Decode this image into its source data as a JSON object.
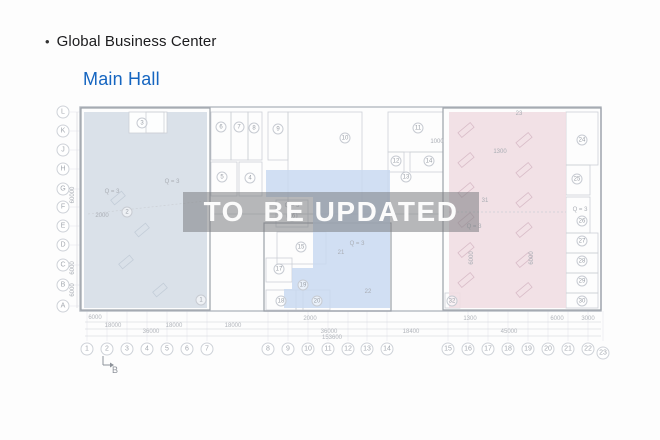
{
  "header": {
    "bullet": "•",
    "title": "Global Business Center",
    "subtitle": "Main Hall"
  },
  "watermark": {
    "text": "TO  BE UPDATED"
  },
  "colors": {
    "title": "#1c1c1e",
    "subtitle": "#1565c0",
    "left_fill": "#d4dce5",
    "mid_fill": "#c9d9f1",
    "right_fill": "#f0dde3",
    "outer_stroke": "#b5bac1",
    "section_stroke": "#9ba1a9",
    "room_stroke": "#ccd0d6",
    "hatch_pink": "#d9bcc8",
    "hatch_gray": "#c3cdd8",
    "dim_line": "#dcdee2",
    "tick_line": "#e9eaee",
    "band": "rgba(124,126,130,0.55)",
    "band_text": "#fbfbfb"
  },
  "plan": {
    "outer": [
      80,
      107,
      521,
      204
    ],
    "sections": [
      [
        81,
        108,
        129,
        202
      ],
      [
        264,
        223,
        127,
        88
      ],
      [
        443,
        108,
        158,
        202
      ]
    ],
    "walls": [
      [
        210,
        214,
        443,
        214
      ],
      [
        388,
        172,
        388,
        214
      ],
      [
        443,
        112,
        443,
        214
      ]
    ],
    "rooms": [
      [
        211,
        112,
        20,
        48
      ],
      [
        231,
        112,
        17,
        48
      ],
      [
        248,
        112,
        14,
        48
      ],
      [
        268,
        112,
        20,
        48
      ],
      [
        288,
        112,
        74,
        102
      ],
      [
        388,
        112,
        55,
        40
      ],
      [
        388,
        152,
        16,
        20
      ],
      [
        410,
        152,
        33,
        20
      ],
      [
        211,
        162,
        26,
        34
      ],
      [
        239,
        162,
        23,
        34
      ],
      [
        276,
        200,
        32,
        27
      ],
      [
        277,
        232,
        49,
        32
      ],
      [
        266,
        258,
        26,
        24
      ],
      [
        266,
        290,
        30,
        20
      ],
      [
        296,
        290,
        7,
        20
      ],
      [
        303,
        290,
        27,
        20
      ],
      [
        566,
        112,
        32,
        53
      ],
      [
        566,
        165,
        24,
        30
      ],
      [
        566,
        197,
        24,
        36
      ],
      [
        566,
        233,
        32,
        20
      ],
      [
        566,
        253,
        32,
        20
      ],
      [
        566,
        273,
        32,
        20
      ],
      [
        566,
        293,
        32,
        15
      ],
      [
        445,
        293,
        15,
        15
      ]
    ],
    "left_region": {
      "rect": [
        84,
        112,
        123,
        196
      ],
      "notch": [
        129,
        112,
        38,
        21
      ],
      "notch_room": [
        146,
        112,
        18,
        21
      ]
    },
    "right_region": {
      "rect": [
        449,
        112,
        117,
        196
      ]
    },
    "blue_polygon": [
      [
        266,
        170
      ],
      [
        390,
        170
      ],
      [
        390,
        308
      ],
      [
        284,
        308
      ],
      [
        284,
        289
      ],
      [
        292,
        289
      ],
      [
        292,
        268
      ],
      [
        313,
        268
      ],
      [
        313,
        197
      ],
      [
        266,
        197
      ]
    ],
    "dashed_lines": [
      [
        449,
        212,
        566,
        212
      ],
      [
        88,
        214,
        205,
        201
      ]
    ],
    "circled_labels": [
      {
        "t": "3",
        "x": 142,
        "y": 123
      },
      {
        "t": "2",
        "x": 127,
        "y": 212
      },
      {
        "t": "1",
        "x": 201,
        "y": 300
      },
      {
        "t": "6",
        "x": 221,
        "y": 127
      },
      {
        "t": "7",
        "x": 239,
        "y": 127
      },
      {
        "t": "8",
        "x": 254,
        "y": 128
      },
      {
        "t": "9",
        "x": 278,
        "y": 129
      },
      {
        "t": "10",
        "x": 345,
        "y": 138
      },
      {
        "t": "11",
        "x": 418,
        "y": 128
      },
      {
        "t": "12",
        "x": 396,
        "y": 161
      },
      {
        "t": "14",
        "x": 429,
        "y": 161
      },
      {
        "t": "13",
        "x": 406,
        "y": 177
      },
      {
        "t": "5",
        "x": 222,
        "y": 177
      },
      {
        "t": "4",
        "x": 250,
        "y": 178
      },
      {
        "t": "15",
        "x": 301,
        "y": 247
      },
      {
        "t": "17",
        "x": 279,
        "y": 269
      },
      {
        "t": "19",
        "x": 303,
        "y": 285
      },
      {
        "t": "18",
        "x": 281,
        "y": 301
      },
      {
        "t": "20",
        "x": 317,
        "y": 301
      },
      {
        "t": "16",
        "x": 292,
        "y": 216
      },
      {
        "t": "24",
        "x": 582,
        "y": 140
      },
      {
        "t": "25",
        "x": 577,
        "y": 179
      },
      {
        "t": "26",
        "x": 582,
        "y": 221
      },
      {
        "t": "27",
        "x": 582,
        "y": 241
      },
      {
        "t": "28",
        "x": 582,
        "y": 261
      },
      {
        "t": "29",
        "x": 582,
        "y": 281
      },
      {
        "t": "30",
        "x": 582,
        "y": 301
      },
      {
        "t": "32",
        "x": 452,
        "y": 301
      }
    ],
    "plain_labels": [
      {
        "t": "Q = 3",
        "x": 112,
        "y": 192
      },
      {
        "t": "Q = 3",
        "x": 172,
        "y": 182
      },
      {
        "t": "2000",
        "x": 102,
        "y": 216
      },
      {
        "t": "Q = 3",
        "x": 292,
        "y": 206
      },
      {
        "t": "Q = 3",
        "x": 357,
        "y": 244
      },
      {
        "t": "21",
        "x": 341,
        "y": 253
      },
      {
        "t": "22",
        "x": 368,
        "y": 292
      },
      {
        "t": "31",
        "x": 485,
        "y": 201
      },
      {
        "t": "Q = 3",
        "x": 474,
        "y": 227
      },
      {
        "t": "Q = 3",
        "x": 580,
        "y": 210
      },
      {
        "t": "1300",
        "x": 500,
        "y": 152
      },
      {
        "t": "1000",
        "x": 437,
        "y": 142
      },
      {
        "t": "23",
        "x": 519,
        "y": 114
      },
      {
        "t": "6000",
        "x": 472,
        "y": 258,
        "rot": true
      },
      {
        "t": "6000",
        "x": 532,
        "y": 258,
        "rot": true
      },
      {
        "t": "60000",
        "x": 73,
        "y": 195,
        "rot": true
      },
      {
        "t": "6000",
        "x": 73,
        "y": 268,
        "rot": true
      },
      {
        "t": "6000",
        "x": 73,
        "y": 290,
        "rot": true
      }
    ],
    "grid_letters": {
      "x": 63,
      "items": [
        {
          "t": "L",
          "y": 112
        },
        {
          "t": "K",
          "y": 131
        },
        {
          "t": "J",
          "y": 150
        },
        {
          "t": "H",
          "y": 169
        },
        {
          "t": "G",
          "y": 189
        },
        {
          "t": "F",
          "y": 207
        },
        {
          "t": "E",
          "y": 226
        },
        {
          "t": "D",
          "y": 245
        },
        {
          "t": "C",
          "y": 265
        },
        {
          "t": "B",
          "y": 285
        },
        {
          "t": "A",
          "y": 306
        }
      ]
    },
    "grid_numbers": {
      "y": 349,
      "items": [
        {
          "t": "1",
          "x": 87
        },
        {
          "t": "2",
          "x": 107
        },
        {
          "t": "3",
          "x": 127
        },
        {
          "t": "4",
          "x": 147
        },
        {
          "t": "5",
          "x": 167
        },
        {
          "t": "6",
          "x": 187
        },
        {
          "t": "7",
          "x": 207
        },
        {
          "t": "8",
          "x": 268
        },
        {
          "t": "9",
          "x": 288
        },
        {
          "t": "10",
          "x": 308
        },
        {
          "t": "11",
          "x": 328
        },
        {
          "t": "12",
          "x": 348
        },
        {
          "t": "13",
          "x": 367
        },
        {
          "t": "14",
          "x": 387
        },
        {
          "t": "15",
          "x": 448
        },
        {
          "t": "16",
          "x": 468
        },
        {
          "t": "17",
          "x": 488
        },
        {
          "t": "18",
          "x": 508
        },
        {
          "t": "19",
          "x": 528
        },
        {
          "t": "20",
          "x": 548
        },
        {
          "t": "21",
          "x": 568
        },
        {
          "t": "22",
          "x": 588
        },
        {
          "t": "23",
          "x": 603,
          "dy": 4
        }
      ]
    },
    "dim_lines": [
      [
        85,
        322,
        601,
        322
      ],
      [
        85,
        329,
        601,
        329
      ],
      [
        85,
        336,
        601,
        336
      ],
      [
        77,
        112,
        77,
        308
      ]
    ],
    "dims": [
      {
        "t": "6000",
        "x": 95,
        "y": 318
      },
      {
        "t": "2000",
        "x": 310,
        "y": 319
      },
      {
        "t": "1300",
        "x": 470,
        "y": 319
      },
      {
        "t": "6000",
        "x": 557,
        "y": 319
      },
      {
        "t": "3000",
        "x": 588,
        "y": 319
      },
      {
        "t": "18000",
        "x": 113,
        "y": 326
      },
      {
        "t": "18000",
        "x": 174,
        "y": 326
      },
      {
        "t": "18000",
        "x": 233,
        "y": 326
      },
      {
        "t": "36000",
        "x": 151,
        "y": 332
      },
      {
        "t": "36000",
        "x": 329,
        "y": 332
      },
      {
        "t": "18400",
        "x": 411,
        "y": 332
      },
      {
        "t": "45000",
        "x": 509,
        "y": 332
      },
      {
        "t": "153600",
        "x": 332,
        "y": 338
      }
    ],
    "hatches": {
      "pink": [
        [
          466,
          130
        ],
        [
          466,
          160
        ],
        [
          466,
          190
        ],
        [
          466,
          220
        ],
        [
          466,
          250
        ],
        [
          466,
          280
        ],
        [
          524,
          140
        ],
        [
          524,
          170
        ],
        [
          524,
          200
        ],
        [
          524,
          230
        ],
        [
          524,
          260
        ],
        [
          524,
          290
        ]
      ],
      "gray": [
        [
          118,
          198
        ],
        [
          142,
          230
        ],
        [
          126,
          262
        ],
        [
          160,
          290
        ]
      ]
    },
    "marker_b": {
      "t": "B",
      "x": 112,
      "y": 370
    }
  }
}
